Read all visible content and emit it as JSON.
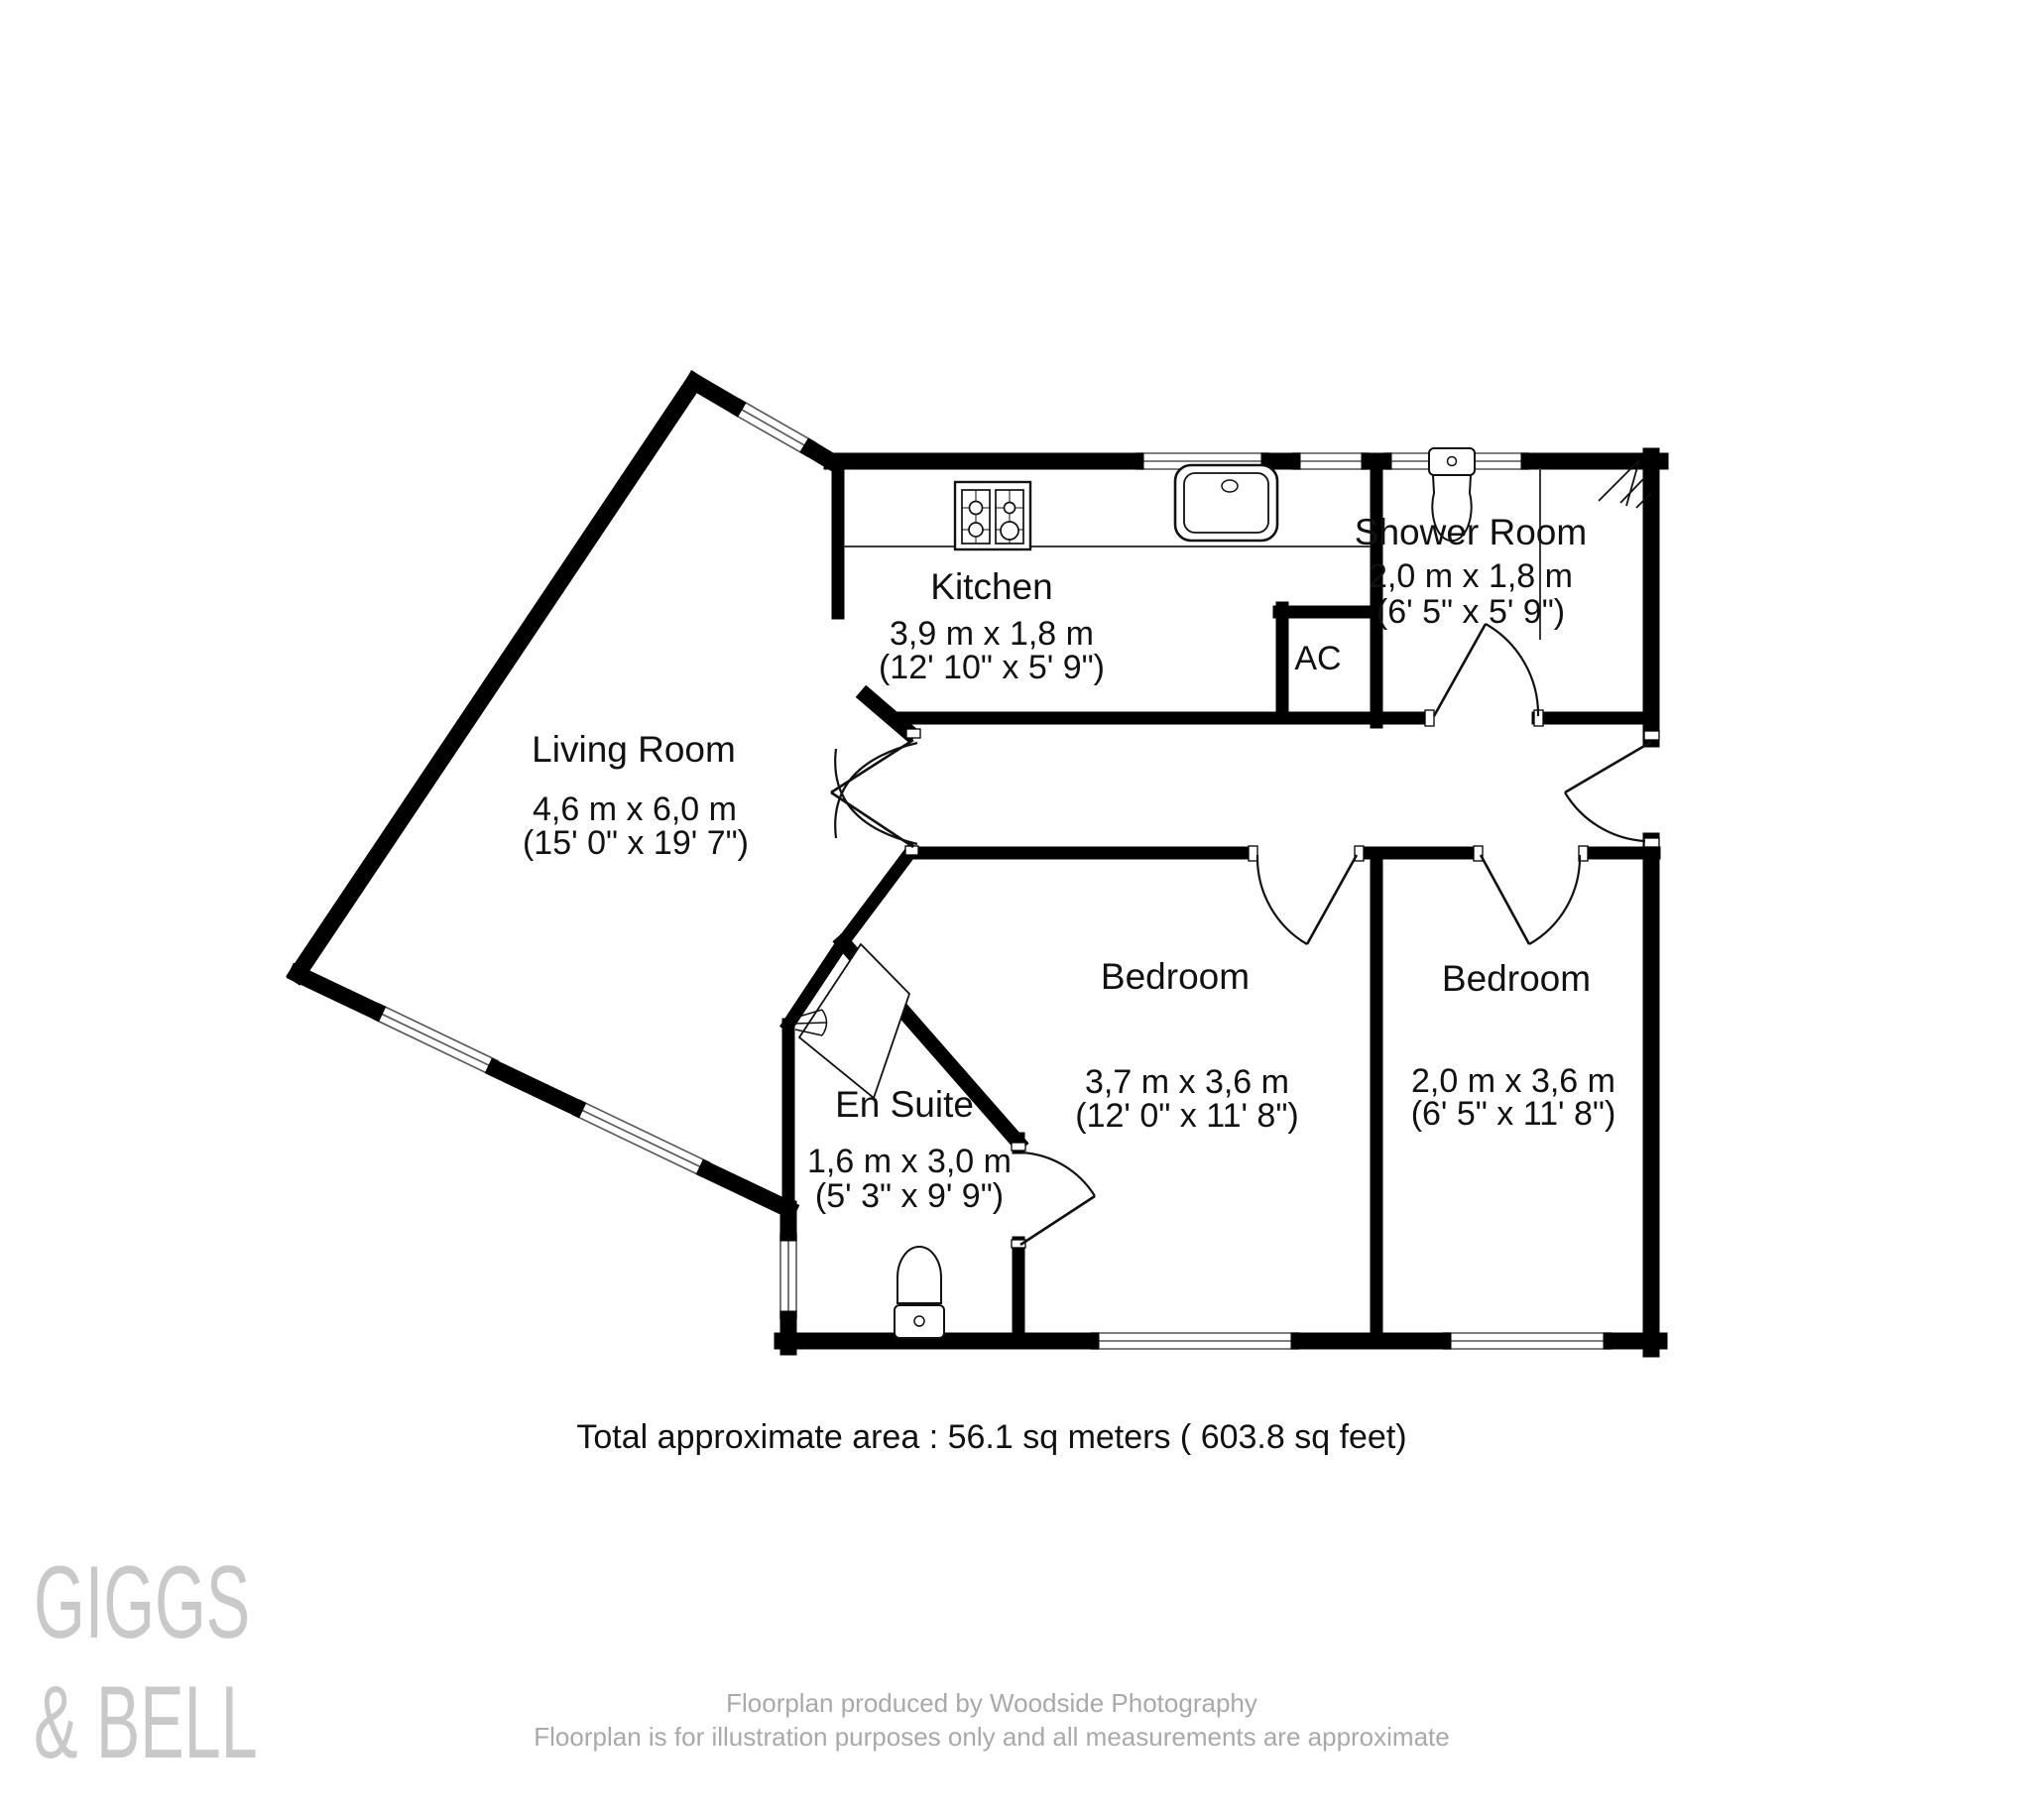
{
  "branding": {
    "line1": "GIGGS",
    "line2": "& BELL"
  },
  "rooms": {
    "living_room": {
      "name": "Living Room",
      "metric": "4,6 m x 6,0 m",
      "imperial": "(15' 0\" x 19' 7\")"
    },
    "kitchen": {
      "name": "Kitchen",
      "metric": "3,9 m x 1,8 m",
      "imperial": "(12' 10\" x 5' 9\")"
    },
    "shower_room": {
      "name": "Shower Room",
      "metric": "2,0 m x 1,8 m",
      "imperial": "(6' 5\" x 5' 9\")"
    },
    "en_suite": {
      "name": "En Suite",
      "metric": "1,6 m x 3,0 m",
      "imperial": "(5' 3\" x 9' 9\")"
    },
    "bedroom_1": {
      "name": "Bedroom",
      "metric": "3,7 m x 3,6 m",
      "imperial": "(12' 0\" x 11' 8\")"
    },
    "bedroom_2": {
      "name": "Bedroom",
      "metric": "2,0 m x 3,6 m",
      "imperial": "(6' 5\" x 11' 8\")"
    },
    "ac": {
      "name": "AC"
    }
  },
  "summary": {
    "total_area": "Total approximate area : 56.1 sq meters ( 603.8 sq feet)"
  },
  "footer": {
    "line1": "Floorplan produced by Woodside Photography",
    "line2": "Floorplan is for illustration purposes only and all measurements are approximate"
  },
  "colors": {
    "wall": "#000000",
    "text": "#111111",
    "muted": "#a9a9a9",
    "logo": "#c9c9c9"
  }
}
